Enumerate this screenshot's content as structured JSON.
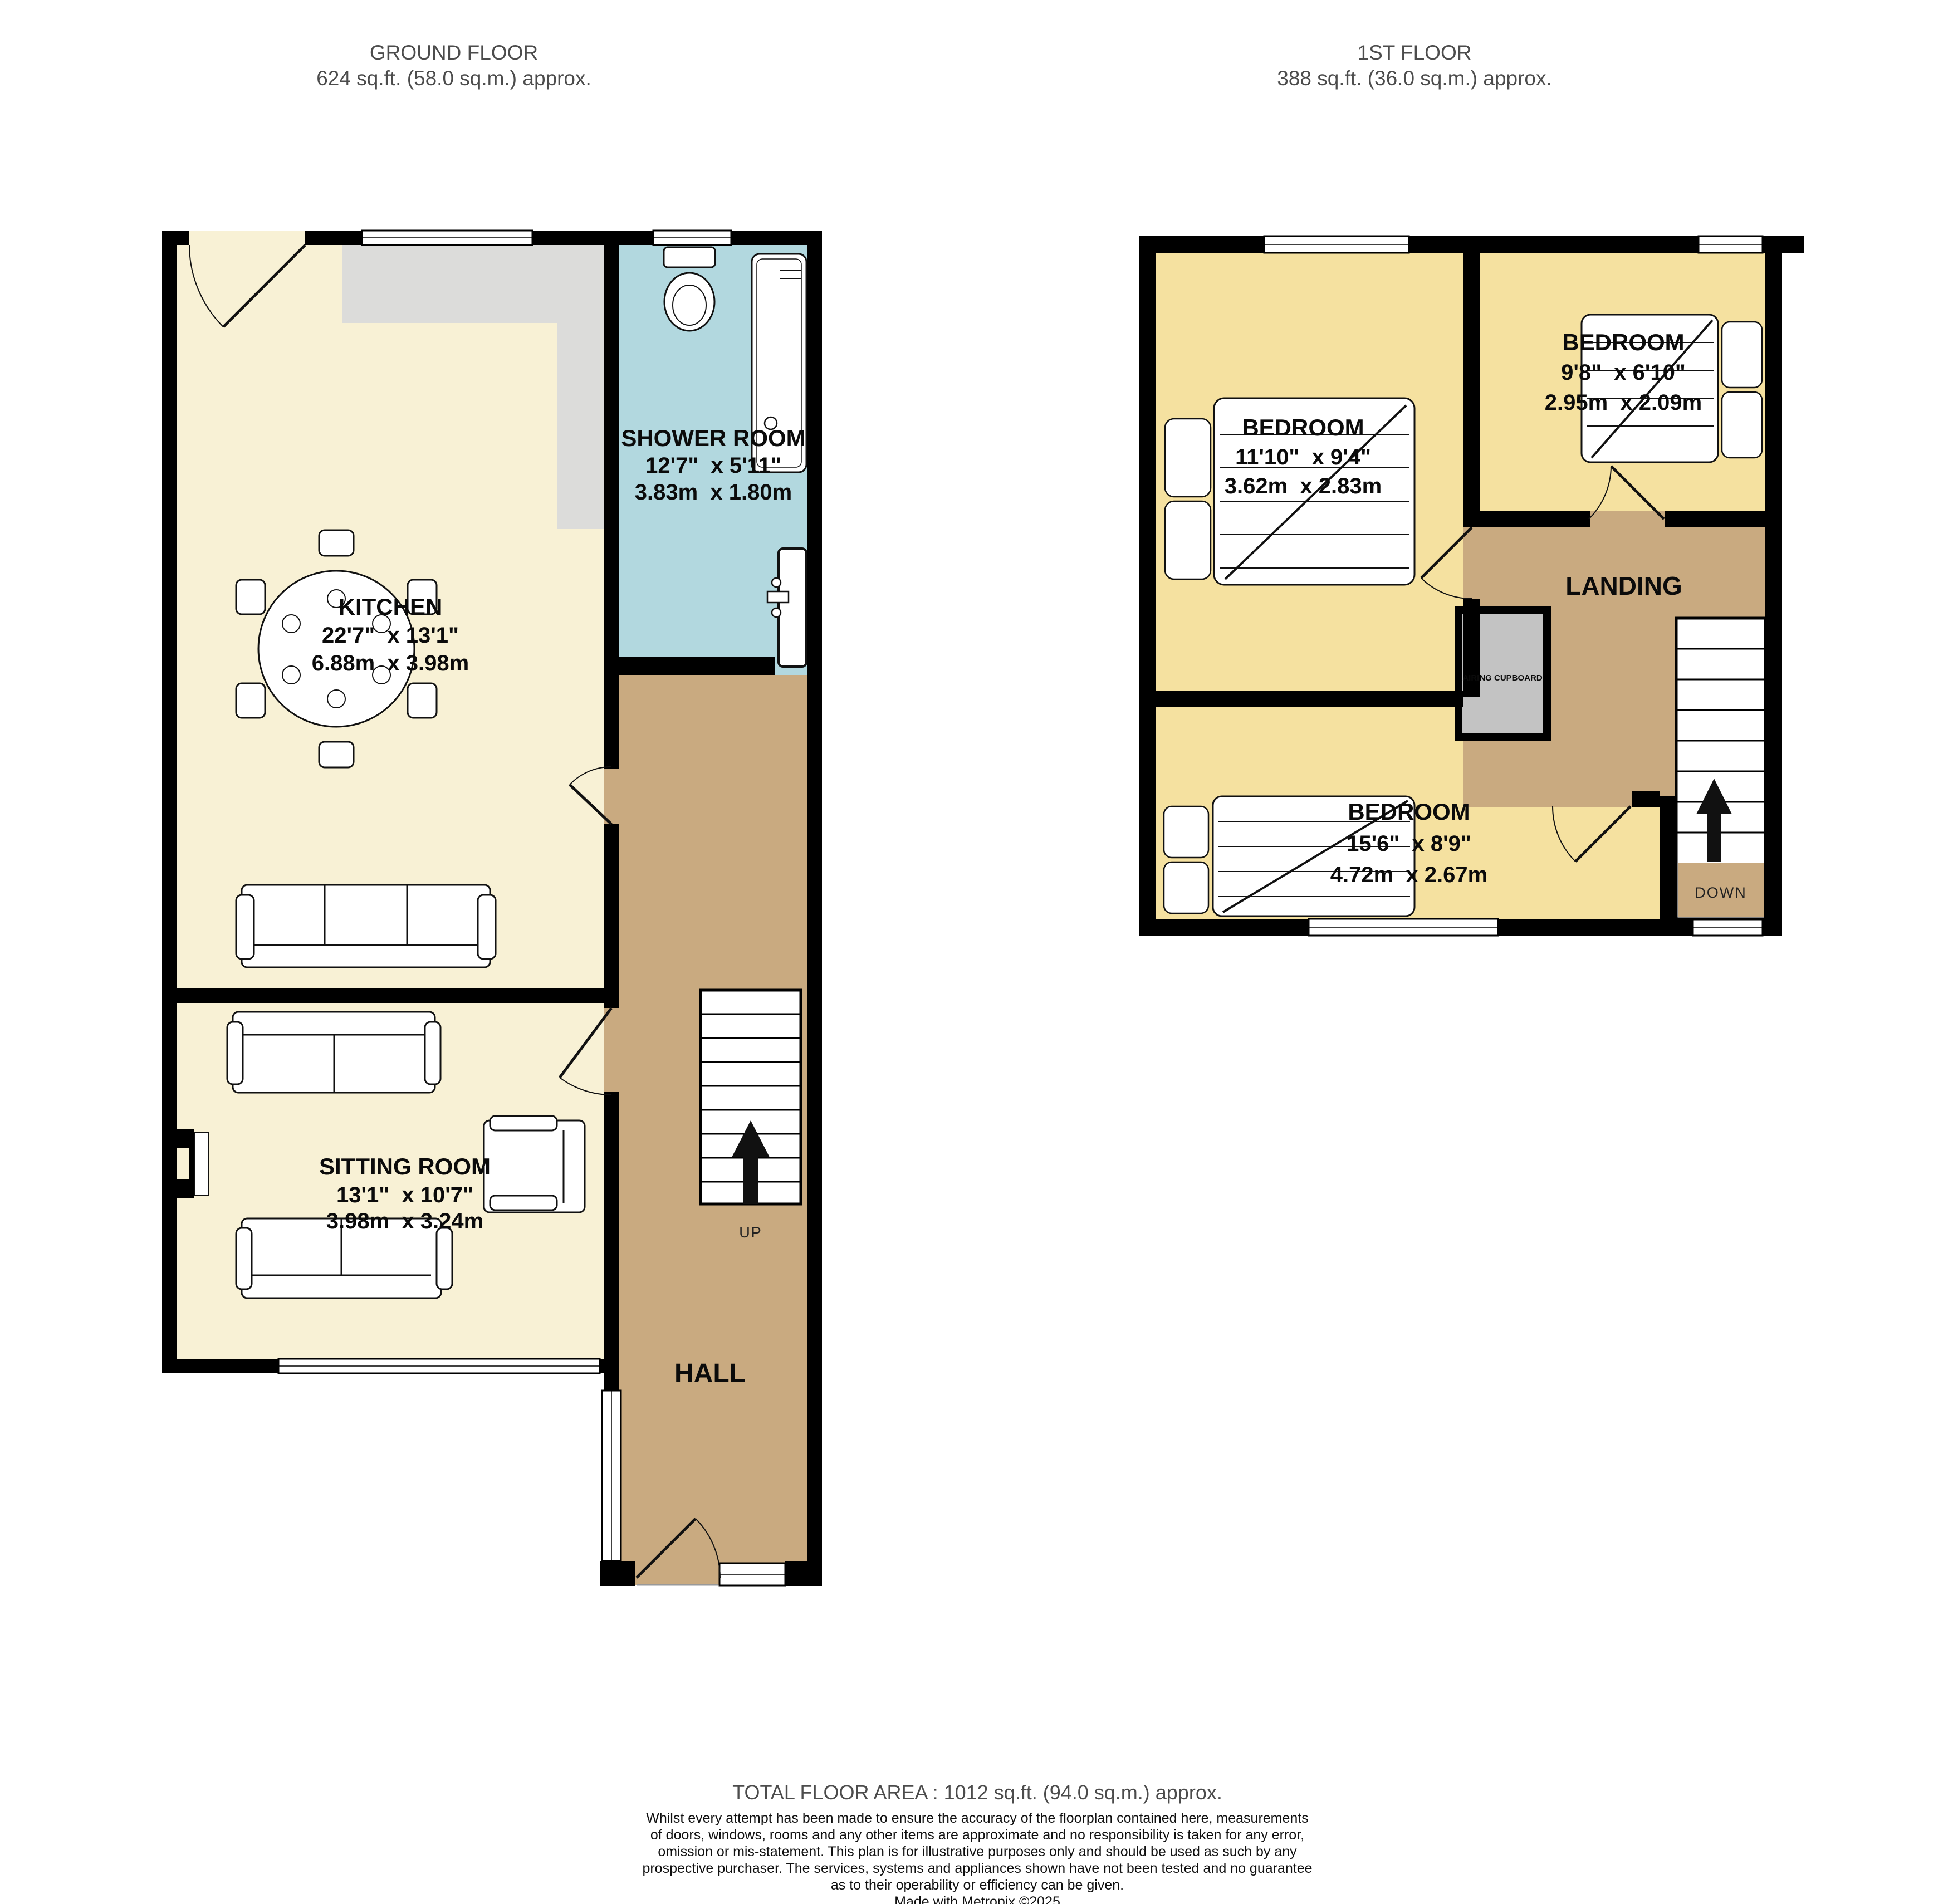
{
  "colors": {
    "wall": "#000000",
    "ground_room_fill": "#f8f1d5",
    "bedroom_fill": "#f5e1a0",
    "hall_landing_fill": "#c9aa80",
    "shower_fill": "#b2d8df",
    "worktop_fill": "#dcdcda",
    "cupboard_fill": "#c3c3c3",
    "header_text": "#4c4c4c"
  },
  "ground_floor": {
    "header": {
      "title": "GROUND FLOOR",
      "area": "624 sq.ft. (58.0 sq.m.) approx."
    },
    "kitchen": {
      "name": "KITCHEN",
      "imperial": "22'7\"  x 13'1\"",
      "metric": "6.88m  x 3.98m"
    },
    "shower_room": {
      "name": "SHOWER ROOM",
      "imperial": "12'7\"  x 5'11\"",
      "metric": "3.83m  x 1.80m"
    },
    "sitting_room": {
      "name": "SITTING ROOM",
      "imperial": "13'1\"  x 10'7\"",
      "metric": "3.98m  x 3.24m"
    },
    "hall": {
      "name": "HALL"
    },
    "stairs": {
      "label": "UP"
    }
  },
  "first_floor": {
    "header": {
      "title": "1ST FLOOR",
      "area": "388 sq.ft. (36.0 sq.m.) approx."
    },
    "bedroom_left": {
      "name": "BEDROOM",
      "imperial": "11'10\"  x 9'4\"",
      "metric": "3.62m  x 2.83m"
    },
    "bedroom_right": {
      "name": "BEDROOM",
      "imperial": "9'8\"  x 6'10\"",
      "metric": "2.95m  x 2.09m"
    },
    "bedroom_bottom": {
      "name": "BEDROOM",
      "imperial": "15'6\"  x 8'9\"",
      "metric": "4.72m  x 2.67m"
    },
    "landing": {
      "name": "LANDING"
    },
    "airing_cupboard": {
      "name": "AIRING CUPBOARD"
    },
    "stairs": {
      "label": "DOWN"
    }
  },
  "footer": {
    "total_area": "TOTAL FLOOR AREA : 1012 sq.ft. (94.0 sq.m.) approx.",
    "disclaimer": [
      "Whilst every attempt has been made to ensure the accuracy of the floorplan contained here, measurements",
      "of doors, windows, rooms and any other items are approximate and no responsibility is taken for any error,",
      "omission or mis-statement. This plan is for illustrative purposes only and should be used as such by any",
      "prospective purchaser. The services, systems and appliances shown have not been tested and no guarantee",
      "as to their operability or efficiency can be given."
    ],
    "credit": "Made with Metropix ©2025"
  }
}
